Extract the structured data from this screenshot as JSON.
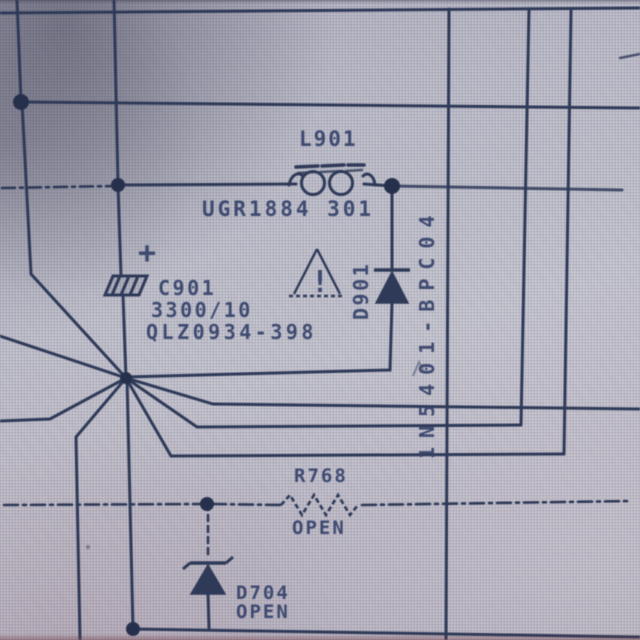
{
  "schematic": {
    "labels": {
      "l901_ref": "L901",
      "l901_part": "UGR1884 301",
      "c901_ref": "C901",
      "c901_value": "3300/10",
      "c901_part": "QLZ0934-398",
      "d901_ref": "D901",
      "d901_part": "1N5401-BPC04",
      "r768_ref": "R768",
      "r768_status": "OPEN",
      "d704_ref": "D704",
      "d704_status": "OPEN",
      "warning_mark": "!",
      "polarity_mark": "+"
    },
    "colors": {
      "ink": "#2e3a58",
      "paper": "#b7b7c3",
      "text_ink": "#35426a"
    }
  }
}
